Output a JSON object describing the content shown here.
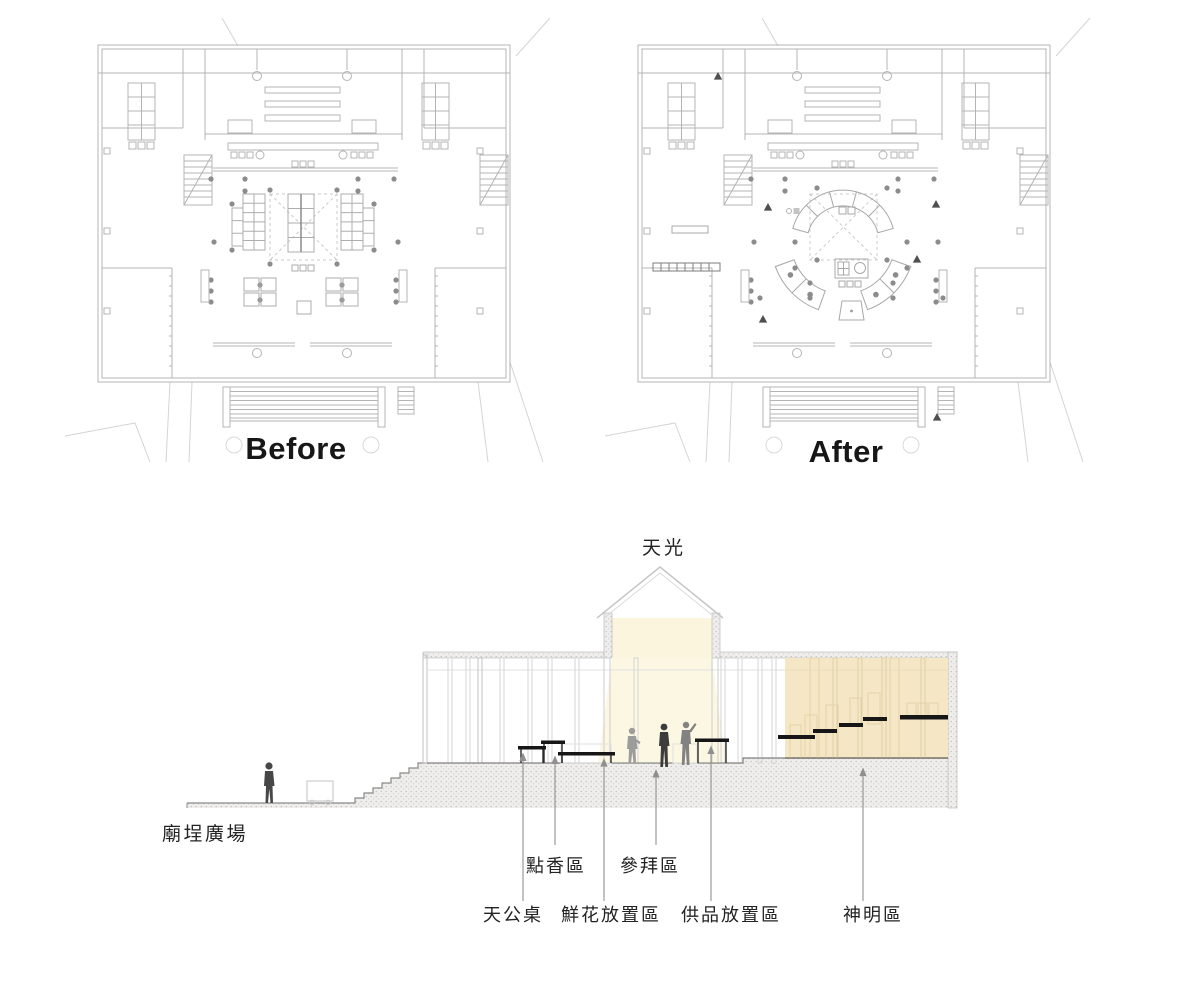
{
  "plans": {
    "before_caption": "Before",
    "after_caption": "After"
  },
  "section": {
    "skylight_label": "天光",
    "plaza_label": "廟埕廣場",
    "labels": {
      "incense": "點香區",
      "worship": "參拜區",
      "tiangong_table": "天公桌",
      "flower_area": "鮮花放置區",
      "offering_area": "供品放置區",
      "deity_area": "神明區"
    }
  },
  "colors": {
    "skylight_yellow": "#faf5dc",
    "deity_orange": "#f5e7c5",
    "plan_line_gray": "#b4b4b4",
    "column_dot_gray": "#8c8c8c",
    "arrow_gray": "#8f8f8f",
    "altar_black": "#161616"
  }
}
